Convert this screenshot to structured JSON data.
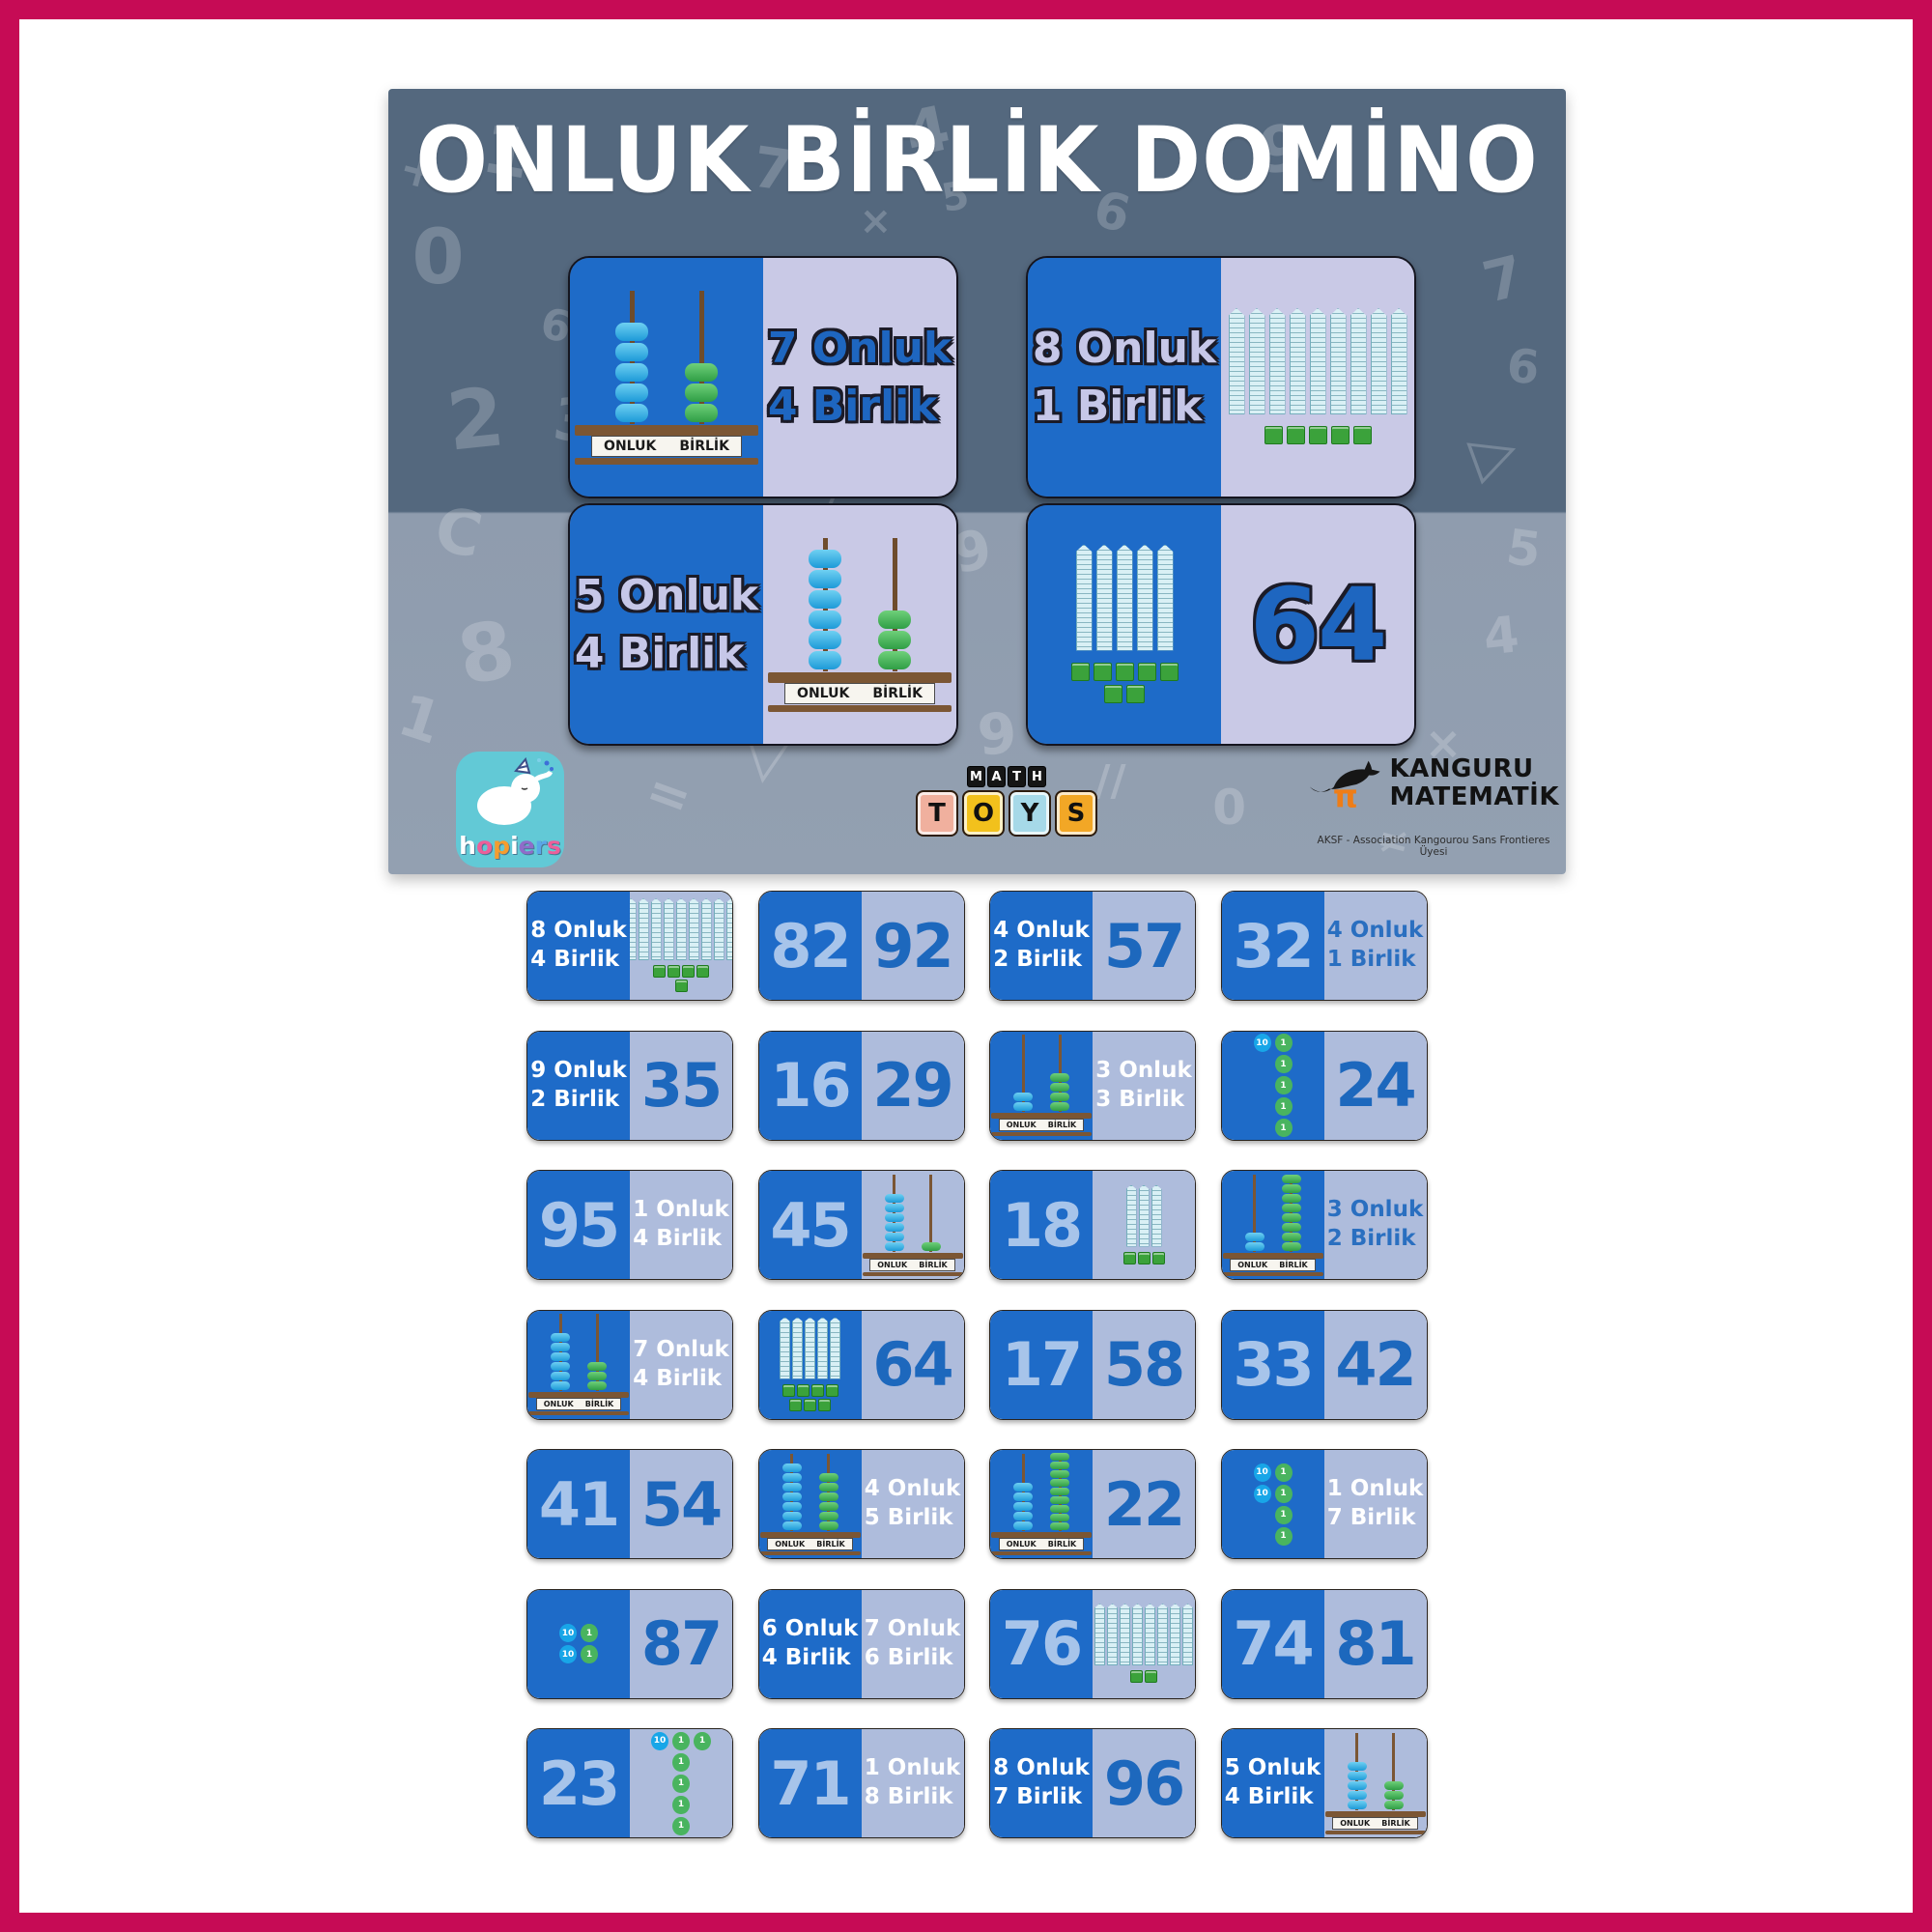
{
  "box": {
    "title": "ONLUK BİRLİK DOMİNO",
    "dominoes": [
      {
        "left": {
          "type": "abacus",
          "tens": 5,
          "ones": 3,
          "bg": "blue"
        },
        "right": {
          "type": "label",
          "lines": [
            "7 Onluk",
            "4 Birlik"
          ],
          "tone": "outblue",
          "bg": "lavender"
        }
      },
      {
        "left": {
          "type": "label",
          "lines": [
            "8 Onluk",
            "1 Birlik"
          ],
          "tone": "outperi",
          "bg": "blue"
        },
        "right": {
          "type": "blocks",
          "rods": 9,
          "cubes": 5,
          "bg": "lavender"
        }
      },
      {
        "left": {
          "type": "label",
          "lines": [
            "5 Onluk",
            "4 Birlik"
          ],
          "tone": "outperi",
          "bg": "blue"
        },
        "right": {
          "type": "abacus",
          "tens": 6,
          "ones": 3,
          "bg": "lavender"
        }
      },
      {
        "left": {
          "type": "blocks",
          "rods": 5,
          "cubes": 7,
          "bg": "blue"
        },
        "right": {
          "type": "number",
          "value": "64",
          "tone": "outblue",
          "bg": "lavender"
        }
      }
    ],
    "logos": {
      "hopiers": {
        "word": "hopiers",
        "letter_colors": [
          "#ffffff",
          "#ec5f9a",
          "#f59c2f",
          "#ffffff",
          "#8f6cc9",
          "#5aa7e8",
          "#ec5f9a"
        ]
      },
      "mathtoys": {
        "top": "MATH",
        "bottom": "TOYS",
        "tile_colors": [
          "#f0b09e",
          "#f2c11c",
          "#a6d9e8",
          "#f2a726"
        ]
      },
      "kanguru": {
        "line1": "KANGURU",
        "line2": "MATEMATİK",
        "subtext": "AKSF - Association Kangourou Sans Frontieres Üyesi"
      }
    },
    "pattern": [
      {
        "ch": "1",
        "x": 8,
        "y": 3,
        "r": 10,
        "s": 70
      },
      {
        "ch": "4",
        "x": 44,
        "y": 1,
        "r": -12,
        "s": 64
      },
      {
        "ch": "7",
        "x": 31,
        "y": 6,
        "r": 8,
        "s": 58
      },
      {
        "ch": "9",
        "x": 74,
        "y": 3,
        "r": -8,
        "s": 66
      },
      {
        "ch": "6",
        "x": 60,
        "y": 12,
        "r": 14,
        "s": 52
      },
      {
        "ch": "0",
        "x": 2,
        "y": 16,
        "r": 0,
        "s": 78
      },
      {
        "ch": "+",
        "x": 1,
        "y": 7,
        "r": 15,
        "s": 48
      },
      {
        "ch": "2",
        "x": 5,
        "y": 36,
        "r": -6,
        "s": 84
      },
      {
        "ch": "3",
        "x": 14,
        "y": 38,
        "r": 6,
        "s": 60
      },
      {
        "ch": "6",
        "x": 13,
        "y": 27,
        "r": 10,
        "s": 44
      },
      {
        "ch": "C",
        "x": 4,
        "y": 52,
        "r": 12,
        "s": 64
      },
      {
        "ch": "8",
        "x": 6,
        "y": 66,
        "r": -10,
        "s": 82
      },
      {
        "ch": "1",
        "x": 1,
        "y": 76,
        "r": 18,
        "s": 60
      },
      {
        "ch": "×",
        "x": 40,
        "y": 14,
        "r": 0,
        "s": 40
      },
      {
        "ch": "5",
        "x": 47,
        "y": 11,
        "r": -10,
        "s": 40
      },
      {
        "ch": "3",
        "x": 55,
        "y": 28,
        "r": -8,
        "s": 56
      },
      {
        "ch": "1",
        "x": 61,
        "y": 36,
        "r": 4,
        "s": 50
      },
      {
        "ch": "7",
        "x": 93,
        "y": 20,
        "r": -14,
        "s": 58
      },
      {
        "ch": "6",
        "x": 95,
        "y": 32,
        "r": 6,
        "s": 48
      },
      {
        "ch": "▷",
        "x": 92,
        "y": 42,
        "r": -20,
        "s": 60
      },
      {
        "ch": "5",
        "x": 95,
        "y": 55,
        "r": 8,
        "s": 50
      },
      {
        "ch": "4",
        "x": 93,
        "y": 66,
        "r": -6,
        "s": 52
      },
      {
        "ch": "9",
        "x": 48,
        "y": 55,
        "r": -10,
        "s": 56
      },
      {
        "ch": "✓",
        "x": 36,
        "y": 50,
        "r": -15,
        "s": 44
      },
      {
        "ch": "▽",
        "x": 30,
        "y": 80,
        "r": 8,
        "s": 66
      },
      {
        "ch": "=",
        "x": 22,
        "y": 86,
        "r": 20,
        "s": 54
      },
      {
        "ch": "9",
        "x": 50,
        "y": 78,
        "r": -5,
        "s": 58
      },
      {
        "ch": "//",
        "x": 60,
        "y": 85,
        "r": 0,
        "s": 44
      },
      {
        "ch": "0",
        "x": 70,
        "y": 88,
        "r": 0,
        "s": 50
      },
      {
        "ch": "×",
        "x": 88,
        "y": 80,
        "r": 0,
        "s": 46
      },
      {
        "ch": "≠",
        "x": 84,
        "y": 93,
        "r": 15,
        "s": 40
      },
      {
        "ch": "○",
        "x": 10,
        "y": 92,
        "r": 0,
        "s": 56
      }
    ]
  },
  "abacus_labels": {
    "tens": "ONLUK",
    "ones": "BİRLİK"
  },
  "colors": {
    "frame": "#c60b55",
    "box_top": "#54687e",
    "box_bottom": "#93a0b1",
    "tile_blue": "#1e6bc8",
    "tile_light": "#aebcdc",
    "box_lavender": "#c9c9e6",
    "number_blue": "#1d68bd",
    "number_light": "#a7c4ea",
    "bead_blue": "#1d9ad8",
    "bead_green": "#2f9e45",
    "counter_ten": "#18a6e8",
    "counter_one": "#49b45f",
    "block_fill": "#d9f0f5",
    "cube_green": "#3ba23b"
  },
  "tiles": [
    {
      "left": {
        "type": "label",
        "lines": [
          "8 Onluk",
          "4 Birlik"
        ],
        "tone": "white",
        "bg": "blue"
      },
      "right": {
        "type": "blocks",
        "rods": 9,
        "cubes": 5,
        "bg": "light"
      }
    },
    {
      "left": {
        "type": "number",
        "value": "82",
        "tone": "light",
        "bg": "blue"
      },
      "right": {
        "type": "number",
        "value": "92",
        "tone": "numblue",
        "bg": "light"
      }
    },
    {
      "left": {
        "type": "label",
        "lines": [
          "4 Onluk",
          "2 Birlik"
        ],
        "tone": "white",
        "bg": "blue"
      },
      "right": {
        "type": "number",
        "value": "57",
        "tone": "numblue",
        "bg": "light"
      }
    },
    {
      "left": {
        "type": "number",
        "value": "32",
        "tone": "light",
        "bg": "blue"
      },
      "right": {
        "type": "label",
        "lines": [
          "4 Onluk",
          "1 Birlik"
        ],
        "tone": "blue",
        "bg": "light"
      }
    },
    {
      "left": {
        "type": "label",
        "lines": [
          "9 Onluk",
          "2 Birlik"
        ],
        "tone": "white",
        "bg": "blue"
      },
      "right": {
        "type": "number",
        "value": "35",
        "tone": "numblue",
        "bg": "light"
      }
    },
    {
      "left": {
        "type": "number",
        "value": "16",
        "tone": "light",
        "bg": "blue"
      },
      "right": {
        "type": "number",
        "value": "29",
        "tone": "numblue",
        "bg": "light"
      }
    },
    {
      "left": {
        "type": "abacus",
        "tens": 2,
        "ones": 4,
        "bg": "blue"
      },
      "right": {
        "type": "label",
        "lines": [
          "3 Onluk",
          "3 Birlik"
        ],
        "tone": "white",
        "bg": "light"
      }
    },
    {
      "left": {
        "type": "counters",
        "grid": [
          [
            "10",
            "1"
          ],
          [
            "",
            "1"
          ],
          [
            "",
            "1"
          ],
          [
            "",
            "1"
          ],
          [
            "",
            "1"
          ]
        ],
        "bg": "blue"
      },
      "right": {
        "type": "number",
        "value": "24",
        "tone": "numblue",
        "bg": "light"
      }
    },
    {
      "left": {
        "type": "number",
        "value": "95",
        "tone": "light",
        "bg": "blue"
      },
      "right": {
        "type": "label",
        "lines": [
          "1 Onluk",
          "4 Birlik"
        ],
        "tone": "white",
        "bg": "light"
      }
    },
    {
      "left": {
        "type": "number",
        "value": "45",
        "tone": "light",
        "bg": "blue"
      },
      "right": {
        "type": "abacus",
        "tens": 6,
        "ones": 1,
        "bg": "light"
      }
    },
    {
      "left": {
        "type": "number",
        "value": "18",
        "tone": "light",
        "bg": "blue"
      },
      "right": {
        "type": "blocks",
        "rods": 3,
        "cubes": 3,
        "bg": "light"
      }
    },
    {
      "left": {
        "type": "abacus",
        "tens": 2,
        "ones": 8,
        "bg": "blue"
      },
      "right": {
        "type": "label",
        "lines": [
          "3 Onluk",
          "2 Birlik"
        ],
        "tone": "blue",
        "bg": "light"
      }
    },
    {
      "left": {
        "type": "abacus",
        "tens": 6,
        "ones": 3,
        "bg": "blue"
      },
      "right": {
        "type": "label",
        "lines": [
          "7 Onluk",
          "4 Birlik"
        ],
        "tone": "white",
        "bg": "light"
      }
    },
    {
      "left": {
        "type": "blocks",
        "rods": 5,
        "cubes": 7,
        "bg": "blue"
      },
      "right": {
        "type": "number",
        "value": "64",
        "tone": "numblue",
        "bg": "light"
      }
    },
    {
      "left": {
        "type": "number",
        "value": "17",
        "tone": "light",
        "bg": "blue"
      },
      "right": {
        "type": "number",
        "value": "58",
        "tone": "numblue",
        "bg": "light"
      }
    },
    {
      "left": {
        "type": "number",
        "value": "33",
        "tone": "light",
        "bg": "blue"
      },
      "right": {
        "type": "number",
        "value": "42",
        "tone": "numblue",
        "bg": "light"
      }
    },
    {
      "left": {
        "type": "number",
        "value": "41",
        "tone": "light",
        "bg": "blue"
      },
      "right": {
        "type": "number",
        "value": "54",
        "tone": "numblue",
        "bg": "light"
      }
    },
    {
      "left": {
        "type": "abacus",
        "tens": 7,
        "ones": 6,
        "bg": "blue"
      },
      "right": {
        "type": "label",
        "lines": [
          "4 Onluk",
          "5 Birlik"
        ],
        "tone": "white",
        "bg": "light"
      }
    },
    {
      "left": {
        "type": "abacus",
        "tens": 5,
        "ones": 9,
        "bg": "blue"
      },
      "right": {
        "type": "number",
        "value": "22",
        "tone": "numblue",
        "bg": "light"
      }
    },
    {
      "left": {
        "type": "counters",
        "grid": [
          [
            "10",
            "1"
          ],
          [
            "10",
            "1"
          ],
          [
            "",
            "1"
          ],
          [
            "",
            "1"
          ]
        ],
        "bg": "blue"
      },
      "right": {
        "type": "label",
        "lines": [
          "1 Onluk",
          "7 Birlik"
        ],
        "tone": "white",
        "bg": "light"
      }
    },
    {
      "left": {
        "type": "counters",
        "grid": [
          [
            "10",
            "1"
          ],
          [
            "10",
            "1"
          ]
        ],
        "bg": "blue"
      },
      "right": {
        "type": "number",
        "value": "87",
        "tone": "numblue",
        "bg": "light"
      }
    },
    {
      "left": {
        "type": "label",
        "lines": [
          "6 Onluk",
          "4 Birlik"
        ],
        "tone": "white",
        "bg": "blue"
      },
      "right": {
        "type": "label",
        "lines": [
          "7 Onluk",
          "6 Birlik"
        ],
        "tone": "white",
        "bg": "light"
      }
    },
    {
      "left": {
        "type": "number",
        "value": "76",
        "tone": "light",
        "bg": "blue"
      },
      "right": {
        "type": "blocks",
        "rods": 8,
        "cubes": 2,
        "bg": "light"
      }
    },
    {
      "left": {
        "type": "number",
        "value": "74",
        "tone": "light",
        "bg": "blue"
      },
      "right": {
        "type": "number",
        "value": "81",
        "tone": "numblue",
        "bg": "light"
      }
    },
    {
      "left": {
        "type": "number",
        "value": "23",
        "tone": "light",
        "bg": "blue"
      },
      "right": {
        "type": "counters",
        "grid": [
          [
            "10",
            "1",
            "1"
          ],
          [
            "",
            "1"
          ],
          [
            "",
            "1"
          ],
          [
            "",
            "1"
          ],
          [
            "",
            "1"
          ]
        ],
        "bg": "light"
      }
    },
    {
      "left": {
        "type": "number",
        "value": "71",
        "tone": "light",
        "bg": "blue"
      },
      "right": {
        "type": "label",
        "lines": [
          "1 Onluk",
          "8 Birlik"
        ],
        "tone": "white",
        "bg": "light"
      }
    },
    {
      "left": {
        "type": "label",
        "lines": [
          "8 Onluk",
          "7 Birlik"
        ],
        "tone": "white",
        "bg": "blue"
      },
      "right": {
        "type": "number",
        "value": "96",
        "tone": "numblue",
        "bg": "light"
      }
    },
    {
      "left": {
        "type": "label",
        "lines": [
          "5 Onluk",
          "4 Birlik"
        ],
        "tone": "white",
        "bg": "blue"
      },
      "right": {
        "type": "abacus",
        "tens": 5,
        "ones": 3,
        "bg": "light"
      }
    }
  ]
}
